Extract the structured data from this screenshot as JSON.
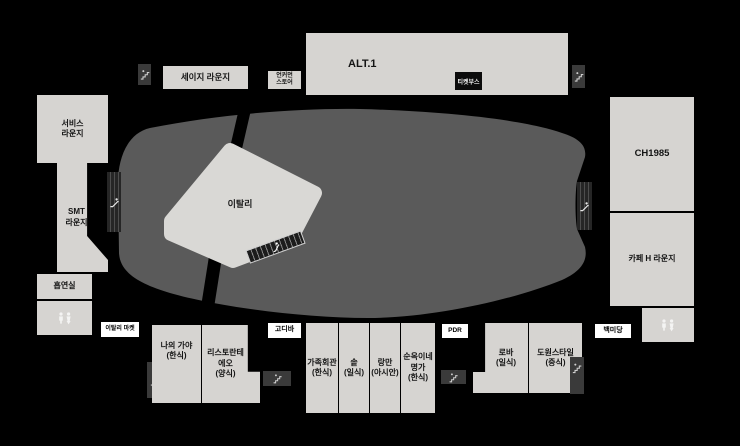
{
  "map_title": "food-hall-floor-plan",
  "colors": {
    "background": "#000000",
    "room_fill": "#d6d4d1",
    "hall_fill": "#5a5a5a",
    "dark_box": "#3a3a3a",
    "label_bg": "#ffffff",
    "ticket_bg": "#0c0c0c",
    "text": "#141414"
  },
  "labels": {
    "sage_lounge": "세이지 라운지",
    "uncommon_store": "언커먼\n스토어",
    "alt1": "ALT.1",
    "ticket_booth": "티켓부스",
    "service_lounge": "서비스\n라운지",
    "smt_lounge": "SMT\n라운지",
    "smoking_room": "흡연실",
    "eataly": "이탈리",
    "eataly_market": "이탈리 마켓",
    "ch1985": "CH1985",
    "cafe_h_lounge": "카페 H 라운지",
    "godiva": "고디바",
    "pdr": "PDR",
    "baekmidang": "백미당",
    "naui_gaya": "나의 가야\n(한식)",
    "ristorante_eo": "리스토란테\n에오\n(양식)",
    "gajokhoegwan": "가족회관\n(한식)",
    "sot": "솥\n(일식)",
    "rangman": "랑만\n(아시안)",
    "sunokine_myeongga": "순옥이네\n명가\n(한식)",
    "roba": "로바\n(일식)",
    "dowon_style": "도원스타일\n(중식)"
  },
  "icons": {
    "stairs": "stairs-icon",
    "escalator": "escalator-icon",
    "restroom": "restroom-icon"
  }
}
